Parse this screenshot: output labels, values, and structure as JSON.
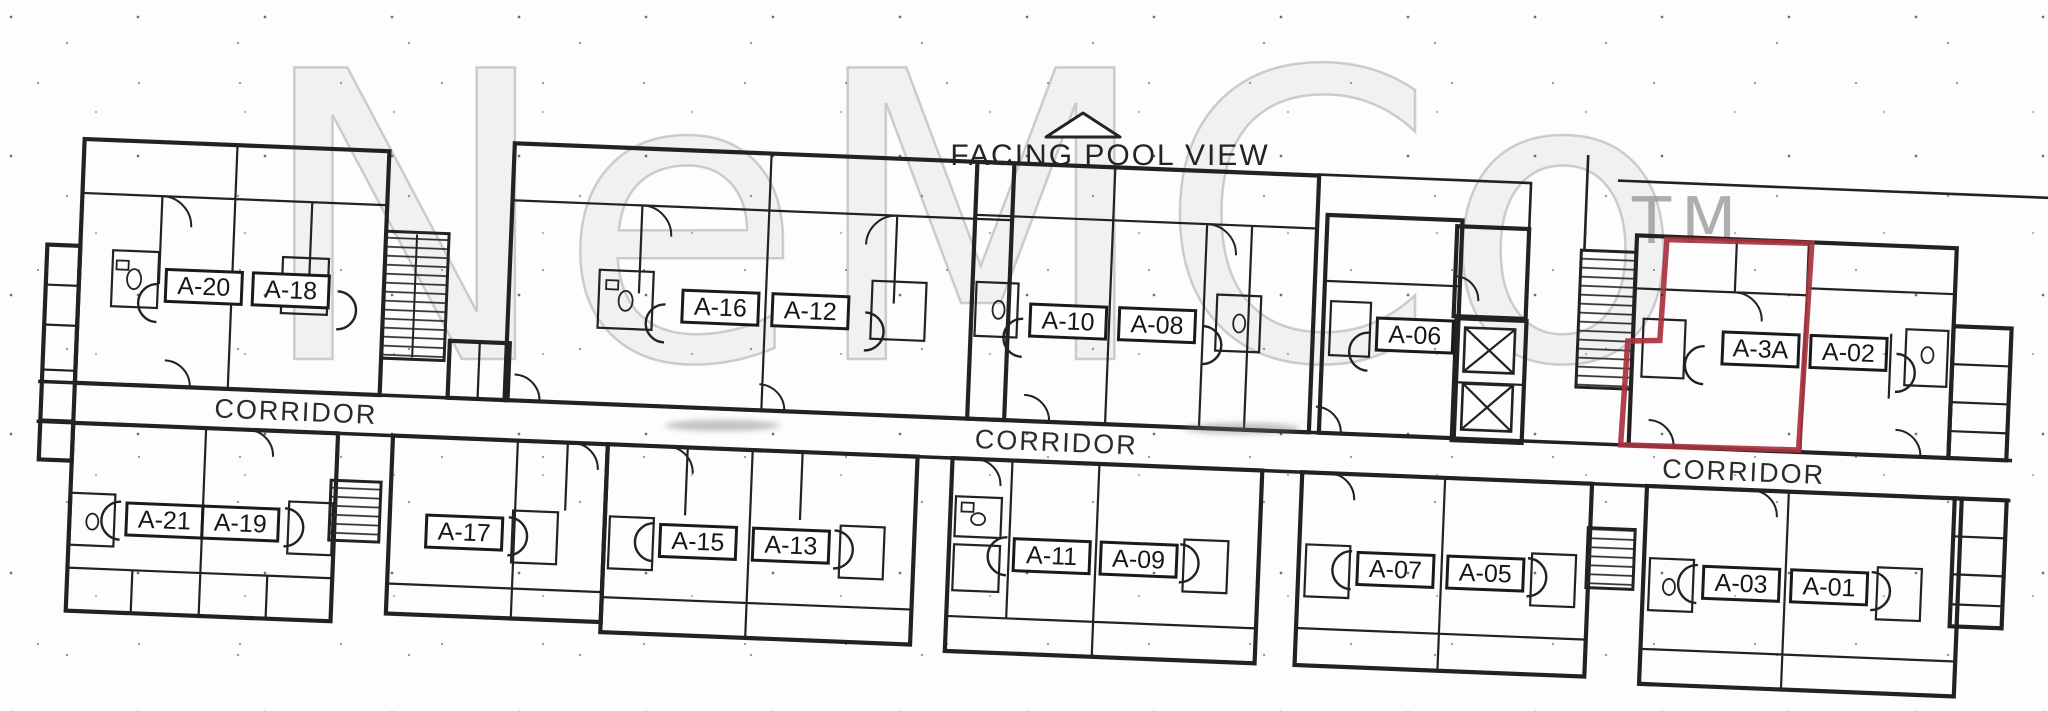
{
  "orientation": {
    "label": "FACING POOL VIEW",
    "symbol": "triangle-up-icon"
  },
  "watermark": {
    "text": "NeMCo",
    "trademark": "TM"
  },
  "corridors": [
    "CORRIDOR",
    "CORRIDOR",
    "CORRIDOR"
  ],
  "units": {
    "top": [
      {
        "label": "A-20"
      },
      {
        "label": "A-18"
      },
      {
        "label": "A-16"
      },
      {
        "label": "A-12"
      },
      {
        "label": "A-10"
      },
      {
        "label": "A-08"
      },
      {
        "label": "A-06"
      },
      {
        "label": "A-3A"
      },
      {
        "label": "A-02"
      }
    ],
    "bottom": [
      {
        "label": "A-21"
      },
      {
        "label": "A-19"
      },
      {
        "label": "A-17"
      },
      {
        "label": "A-15"
      },
      {
        "label": "A-13"
      },
      {
        "label": "A-11"
      },
      {
        "label": "A-09"
      },
      {
        "label": "A-07"
      },
      {
        "label": "A-05"
      },
      {
        "label": "A-03"
      },
      {
        "label": "A-01"
      }
    ]
  },
  "highlighted_unit": {
    "label": "A-3A",
    "outline_color": "#a8323f"
  },
  "colors": {
    "ink": "#222222",
    "paper": "#fdfdfd",
    "watermark_gray": "#b9b9b9",
    "highlight_red": "#a8323f"
  }
}
